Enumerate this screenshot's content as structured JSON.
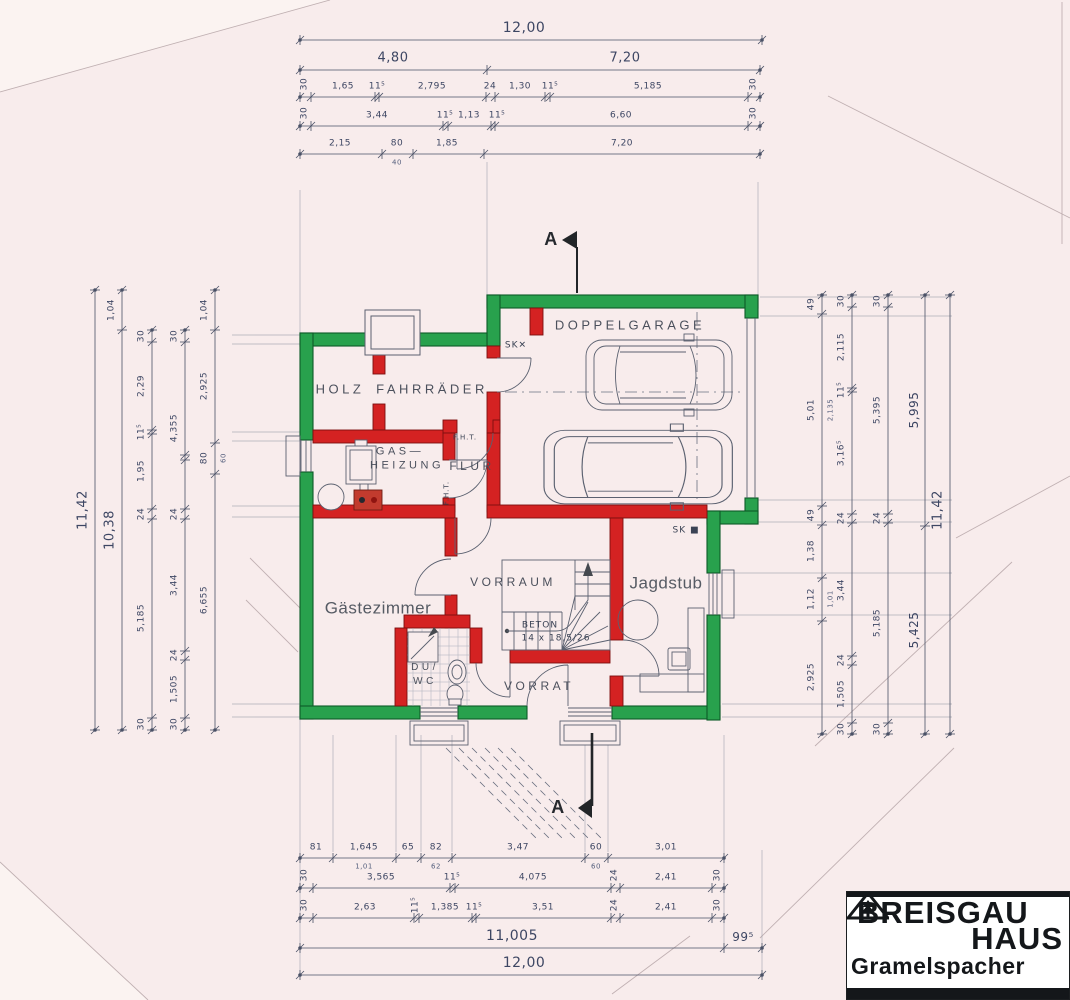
{
  "colors": {
    "wall_exterior": "#28a14d",
    "wall_interior": "#d42222",
    "paper": "#f8ecec",
    "ink": "#3d4663",
    "line": "#5b6170"
  },
  "rooms": [
    {
      "n": "room-label-holz",
      "t": "HOLZ",
      "x": 340,
      "y": 389,
      "s": 13,
      "cls": "room"
    },
    {
      "n": "room-label-fahrraeder",
      "t": "FAHRRÄDER",
      "x": 432,
      "y": 389,
      "s": 13,
      "cls": "room"
    },
    {
      "n": "room-label-doppelgarage",
      "t": "DOPPELGARAGE",
      "x": 630,
      "y": 325,
      "s": 13,
      "cls": "room"
    },
    {
      "n": "room-label-gas",
      "t": "GAS—",
      "x": 400,
      "y": 452,
      "s": 11,
      "cls": "room"
    },
    {
      "n": "room-label-heizung",
      "t": "HEIZUNG",
      "x": 407,
      "y": 466,
      "s": 11,
      "cls": "room"
    },
    {
      "n": "room-label-flur",
      "t": "FLUR",
      "x": 472,
      "y": 466,
      "s": 12,
      "cls": "room"
    },
    {
      "n": "room-label-gaestezimmer",
      "t": "Gästezimmer",
      "x": 378,
      "y": 608,
      "s": 17,
      "cls": "roomlc"
    },
    {
      "n": "room-label-vorraum",
      "t": "VORRAUM",
      "x": 513,
      "y": 582,
      "s": 12,
      "cls": "room"
    },
    {
      "n": "room-label-jagdstub",
      "t": "Jagdstub",
      "x": 666,
      "y": 583,
      "s": 17,
      "cls": "roomlc"
    },
    {
      "n": "room-label-du",
      "t": "DU/",
      "x": 425,
      "y": 668,
      "s": 10,
      "cls": "room"
    },
    {
      "n": "room-label-wc",
      "t": "WC",
      "x": 425,
      "y": 682,
      "s": 10,
      "cls": "room"
    },
    {
      "n": "room-label-vorrat",
      "t": "VORRAT",
      "x": 539,
      "y": 686,
      "s": 12,
      "cls": "room"
    }
  ],
  "notes": [
    {
      "n": "stair-material-label",
      "t": "BETON",
      "x": 540,
      "y": 626,
      "s": 9,
      "cls": "note"
    },
    {
      "n": "stair-step-dimensions",
      "t": "14 x 18,5/26",
      "x": 556,
      "y": 639,
      "s": 9,
      "cls": "note"
    },
    {
      "n": "sk-symbol-garage",
      "t": "SK✕",
      "x": 516,
      "y": 346,
      "s": 9,
      "cls": "note"
    },
    {
      "n": "sk-symbol-jagdstub",
      "t": "SK ■",
      "x": 686,
      "y": 531,
      "s": 9,
      "cls": "note"
    },
    {
      "n": "fire-door-label-top",
      "t": "F.H.T.",
      "x": 465,
      "y": 438,
      "s": 7,
      "cls": "note"
    },
    {
      "n": "fire-door-label-side",
      "t": "F.H.T.",
      "x": 447,
      "y": 493,
      "s": 7,
      "r": -90,
      "cls": "note"
    },
    {
      "n": "section-mark-a-top",
      "t": "A",
      "x": 551,
      "y": 239,
      "s": 18,
      "cls": "secA"
    },
    {
      "n": "section-mark-a-bottom",
      "t": "A",
      "x": 558,
      "y": 807,
      "s": 18,
      "cls": "secA"
    }
  ],
  "dims": {
    "chains": [
      {
        "o": "h",
        "pos": 40,
        "a": 300,
        "b": 762,
        "ticks": [
          300,
          762
        ],
        "labels": [
          {
            "t": "12,00",
            "at": 524,
            "s": 14
          }
        ]
      },
      {
        "o": "h",
        "pos": 70,
        "a": 300,
        "b": 760,
        "ticks": [
          300,
          487,
          760
        ],
        "labels": [
          {
            "t": "4,80",
            "at": 393,
            "s": 13
          },
          {
            "t": "7,20",
            "at": 625,
            "s": 13
          }
        ]
      },
      {
        "o": "h",
        "pos": 97,
        "a": 300,
        "b": 760,
        "ticks": [
          300,
          311,
          375,
          379,
          486,
          495,
          545,
          550,
          748,
          760
        ],
        "labels": [
          {
            "t": "30",
            "at": 305,
            "rot": true
          },
          {
            "t": "1,65",
            "at": 343
          },
          {
            "t": "11⁵",
            "at": 377
          },
          {
            "t": "2,795",
            "at": 432
          },
          {
            "t": "24",
            "at": 490
          },
          {
            "t": "1,30",
            "at": 520
          },
          {
            "t": "11⁵",
            "at": 550
          },
          {
            "t": "5,185",
            "at": 648
          },
          {
            "t": "30",
            "at": 754,
            "rot": true
          }
        ]
      },
      {
        "o": "h",
        "pos": 126,
        "a": 300,
        "b": 760,
        "ticks": [
          300,
          311,
          443,
          448,
          491,
          495,
          748,
          760
        ],
        "labels": [
          {
            "t": "30",
            "at": 305,
            "rot": true
          },
          {
            "t": "3,44",
            "at": 377
          },
          {
            "t": "11⁵",
            "at": 445
          },
          {
            "t": "1,13",
            "at": 469
          },
          {
            "t": "11⁵",
            "at": 497
          },
          {
            "t": "6,60",
            "at": 621
          },
          {
            "t": "30",
            "at": 754,
            "rot": true
          }
        ]
      },
      {
        "o": "h",
        "pos": 154,
        "a": 300,
        "b": 760,
        "ticks": [
          300,
          382,
          413,
          484,
          760
        ],
        "labels": [
          {
            "t": "2,15",
            "at": 340
          },
          {
            "t": "80",
            "at": 397,
            "sub": "40"
          },
          {
            "t": "1,85",
            "at": 447
          },
          {
            "t": "7,20",
            "at": 622
          }
        ]
      },
      {
        "o": "h",
        "pos": 858,
        "a": 300,
        "b": 724,
        "ticks": [
          300,
          333,
          396,
          421,
          452,
          585,
          608,
          724
        ],
        "labels": [
          {
            "t": "81",
            "at": 316
          },
          {
            "t": "1,645",
            "at": 364,
            "sub": "1,01"
          },
          {
            "t": "65",
            "at": 408
          },
          {
            "t": "82",
            "at": 436,
            "sub": "62"
          },
          {
            "t": "3,47",
            "at": 518
          },
          {
            "t": "60",
            "at": 596,
            "sub": "60"
          },
          {
            "t": "3,01",
            "at": 666
          }
        ]
      },
      {
        "o": "h",
        "pos": 888,
        "a": 300,
        "b": 724,
        "ticks": [
          300,
          313,
          450,
          455,
          611,
          620,
          712,
          724
        ],
        "labels": [
          {
            "t": "30",
            "at": 305,
            "rot": true
          },
          {
            "t": "3,565",
            "at": 381
          },
          {
            "t": "11⁵",
            "at": 452
          },
          {
            "t": "4,075",
            "at": 533
          },
          {
            "t": "24",
            "at": 615,
            "rot": true
          },
          {
            "t": "2,41",
            "at": 666
          },
          {
            "t": "30",
            "at": 718,
            "rot": true
          }
        ]
      },
      {
        "o": "h",
        "pos": 918,
        "a": 300,
        "b": 724,
        "ticks": [
          300,
          313,
          414,
          419,
          472,
          476,
          611,
          620,
          712,
          724
        ],
        "labels": [
          {
            "t": "30",
            "at": 305,
            "rot": true
          },
          {
            "t": "2,63",
            "at": 365
          },
          {
            "t": "11⁵",
            "at": 416,
            "rot": true
          },
          {
            "t": "1,385",
            "at": 445
          },
          {
            "t": "11⁵",
            "at": 474
          },
          {
            "t": "3,51",
            "at": 543
          },
          {
            "t": "24",
            "at": 615,
            "rot": true
          },
          {
            "t": "2,41",
            "at": 666
          },
          {
            "t": "30",
            "at": 718,
            "rot": true
          }
        ]
      },
      {
        "o": "h",
        "pos": 948,
        "a": 300,
        "b": 762,
        "ticks": [
          300,
          724,
          762
        ],
        "labels": [
          {
            "t": "11,005",
            "at": 512,
            "s": 14
          },
          {
            "t": "99⁵",
            "at": 743,
            "s": 12
          }
        ]
      },
      {
        "o": "h",
        "pos": 975,
        "a": 300,
        "b": 762,
        "ticks": [
          300,
          762
        ],
        "labels": [
          {
            "t": "12,00",
            "at": 524,
            "s": 14
          }
        ]
      },
      {
        "o": "v",
        "pos": 95,
        "a": 290,
        "b": 730,
        "ticks": [
          290,
          730
        ],
        "labels": [
          {
            "t": "11,42",
            "at": 510,
            "s": 13
          }
        ]
      },
      {
        "o": "v",
        "pos": 122,
        "a": 290,
        "b": 730,
        "ticks": [
          290,
          330,
          730
        ],
        "labels": [
          {
            "t": "1,04",
            "at": 310
          },
          {
            "t": "10,38",
            "at": 530,
            "s": 13
          }
        ]
      },
      {
        "o": "v",
        "pos": 152,
        "a": 330,
        "b": 730,
        "ticks": [
          330,
          342,
          430,
          434,
          509,
          519,
          718,
          730
        ],
        "labels": [
          {
            "t": "30",
            "at": 336
          },
          {
            "t": "2,29",
            "at": 386
          },
          {
            "t": "11⁵",
            "at": 432
          },
          {
            "t": "1,95",
            "at": 471
          },
          {
            "t": "24",
            "at": 514
          },
          {
            "t": "5,185",
            "at": 618
          },
          {
            "t": "30",
            "at": 724
          }
        ]
      },
      {
        "o": "v",
        "pos": 185,
        "a": 330,
        "b": 730,
        "ticks": [
          330,
          342,
          455,
          460,
          509,
          519,
          651,
          660,
          718,
          730
        ],
        "labels": [
          {
            "t": "30",
            "at": 336
          },
          {
            "t": "4,355",
            "at": 428
          },
          {
            "t": "24",
            "at": 514
          },
          {
            "t": "3,44",
            "at": 585
          },
          {
            "t": "24",
            "at": 655
          },
          {
            "t": "1,505",
            "at": 689
          },
          {
            "t": "30",
            "at": 724
          }
        ]
      },
      {
        "o": "v",
        "pos": 215,
        "a": 290,
        "b": 730,
        "ticks": [
          290,
          330,
          443,
          474,
          730
        ],
        "labels": [
          {
            "t": "1,04",
            "at": 310
          },
          {
            "t": "2,925",
            "at": 386
          },
          {
            "t": "80",
            "at": 458,
            "sub": "60"
          },
          {
            "t": "6,655",
            "at": 600
          }
        ]
      },
      {
        "o": "v",
        "pos": 822,
        "a": 295,
        "b": 734,
        "ticks": [
          295,
          314,
          506,
          525,
          578,
          621,
          734
        ],
        "labels": [
          {
            "t": "49",
            "at": 304
          },
          {
            "t": "5,01",
            "at": 410,
            "sub": "2,135"
          },
          {
            "t": "49",
            "at": 515
          },
          {
            "t": "1,38",
            "at": 551
          },
          {
            "t": "1,12",
            "at": 599,
            "sub": "1,01"
          },
          {
            "t": "2,925",
            "at": 677
          }
        ]
      },
      {
        "o": "v",
        "pos": 852,
        "a": 295,
        "b": 734,
        "ticks": [
          295,
          307,
          388,
          392,
          514,
          523,
          656,
          665,
          723,
          734
        ],
        "labels": [
          {
            "t": "30",
            "at": 301
          },
          {
            "t": "2,115",
            "at": 347
          },
          {
            "t": "11⁵",
            "at": 390
          },
          {
            "t": "3,16⁵",
            "at": 453
          },
          {
            "t": "24",
            "at": 518
          },
          {
            "t": "3,44",
            "at": 590
          },
          {
            "t": "24",
            "at": 660
          },
          {
            "t": "1,505",
            "at": 694
          },
          {
            "t": "30",
            "at": 729
          }
        ]
      },
      {
        "o": "v",
        "pos": 888,
        "a": 295,
        "b": 734,
        "ticks": [
          295,
          307,
          514,
          523,
          723,
          734
        ],
        "labels": [
          {
            "t": "30",
            "at": 301
          },
          {
            "t": "5,395",
            "at": 410
          },
          {
            "t": "24",
            "at": 518
          },
          {
            "t": "5,185",
            "at": 623
          },
          {
            "t": "30",
            "at": 729
          }
        ]
      },
      {
        "o": "v",
        "pos": 925,
        "a": 295,
        "b": 734,
        "ticks": [
          295,
          526,
          734
        ],
        "labels": [
          {
            "t": "5,995",
            "at": 410,
            "s": 12
          },
          {
            "t": "5,425",
            "at": 630,
            "s": 12
          }
        ]
      },
      {
        "o": "v",
        "pos": 950,
        "a": 295,
        "b": 734,
        "ticks": [
          295,
          734
        ],
        "labels": [
          {
            "t": "11,42",
            "at": 510,
            "s": 13
          }
        ]
      }
    ]
  },
  "logo": {
    "line1": "BREISGAU",
    "line2": "HAUS",
    "line3": "Gramelspacher"
  }
}
